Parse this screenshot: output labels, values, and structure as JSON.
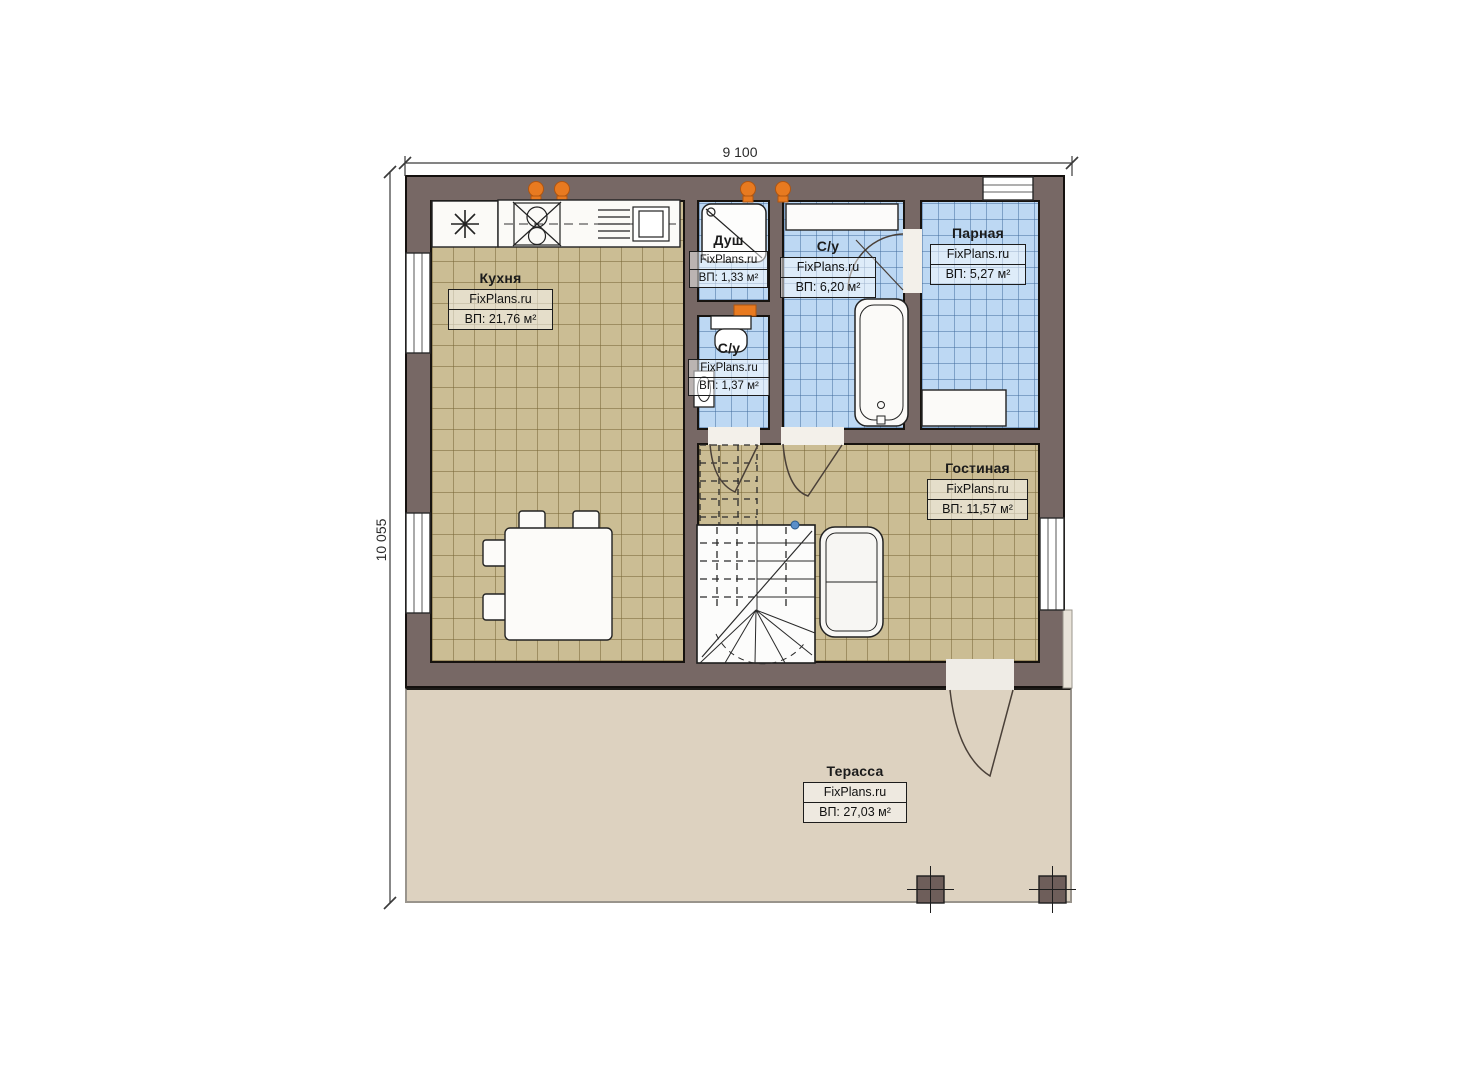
{
  "plan_title": "Floor plan (first floor)",
  "dimensions": {
    "top": "9 100",
    "left": "10 055"
  },
  "brand": "FixPlans.ru",
  "rooms": {
    "kitchen": {
      "name": "Кухня",
      "watermark": "FixPlans.ru",
      "area": "ВП: 21,76 м²"
    },
    "shower": {
      "name": "Душ",
      "watermark": "FixPlans.ru",
      "area": "ВП: 1,33 м²"
    },
    "bathroom": {
      "name": "С/у",
      "watermark": "FixPlans.ru",
      "area": "ВП: 6,20 м²"
    },
    "sauna": {
      "name": "Парная",
      "watermark": "FixPlans.ru",
      "area": "ВП: 5,27 м²"
    },
    "wc": {
      "name": "С/у",
      "watermark": "FixPlans.ru",
      "area": "ВП: 1,37 м²"
    },
    "living": {
      "name": "Гостиная",
      "watermark": "FixPlans.ru",
      "area": "ВП: 11,57 м²"
    },
    "terrace": {
      "name": "Терасса",
      "watermark": "FixPlans.ru",
      "area": "ВП: 27,03 м²"
    }
  },
  "colors": {
    "wall": "#776865",
    "floor_tan": "#cbbd94",
    "floor_blue": "#bdd8f3",
    "terrace": "#ddd2c0",
    "radiator_orange": "#e87a20",
    "line": "#1c1c1c"
  }
}
